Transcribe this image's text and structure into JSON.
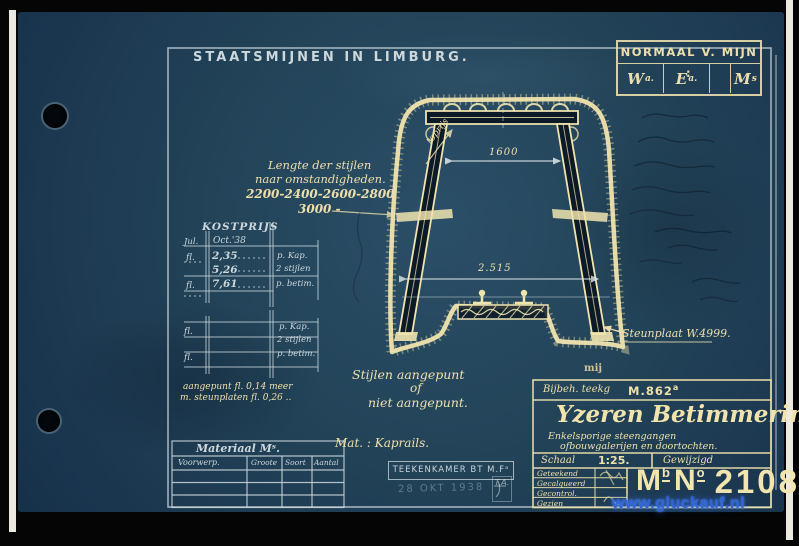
{
  "header": {
    "title": "STAATSMIJNEN  IN  LIMBURG."
  },
  "normaal": {
    "label": "NORMAAL V. MIJN :",
    "cells": [
      {
        "main": "W",
        "sup": "a."
      },
      {
        "main": "E",
        "sup": "a."
      },
      {
        "main": "",
        "sup": ""
      },
      {
        "main": "M",
        "sup": "s"
      }
    ]
  },
  "lengte": {
    "line1": "Lengte der stijlen",
    "line2": "naar omstandigheden.",
    "line3": "2200-2400-2600-2800",
    "line4": "3000 -"
  },
  "kostprijs": {
    "title": "KOSTPRIJS",
    "head_left": "Jul.",
    "head_right": "Oct.'38",
    "rows_top": [
      {
        "fl": "fl.",
        "value": "2,35",
        "unit": "p. Kap."
      },
      {
        "fl": "",
        "value": "5,26",
        "unit": "2 stijlen"
      },
      {
        "fl": "fl.",
        "value": "7,61",
        "unit": "p. betim."
      }
    ],
    "rows_bottom": [
      {
        "fl": "fl.",
        "unit": "p. Kap."
      },
      {
        "fl": "",
        "unit": "2 stijlen"
      },
      {
        "fl": "fl.",
        "unit": "p. betim."
      }
    ],
    "note_line1": "aangepunt  fl. 0,14 meer",
    "note_line2": "m. steunplaten fl. 0,26 .."
  },
  "drawing": {
    "dim_top": "1600",
    "dim_bottom": "2.515",
    "toprijs_label": "toprijs",
    "steunplaat_label": "Steunplaat  W.4999.",
    "mij_label": "mij"
  },
  "notes": {
    "stijlen_line1": "Stijlen aangepunt",
    "stijlen_line2": "of",
    "stijlen_line3": "niet aangepunt.",
    "mat_label": "Mat. : Kaprails."
  },
  "materiaal": {
    "title": "Materiaal Mˢ.",
    "columns": [
      "Voorwerp.",
      "Groote",
      "Soort",
      "Aantal"
    ]
  },
  "stamp": {
    "line1": "TEEKENKAMER BT M.Fᵃ",
    "date": "28 OKT 1938",
    "monogram": "T.A."
  },
  "titleblock": {
    "bijbeh_label": "Bijbeh. teekg",
    "bijbeh_number": "M.862",
    "bijbeh_sup": "a",
    "main_title": "Yzeren Betimmering",
    "main_title_suffix": "v.",
    "subtitle1": "Enkelsporige steengangen",
    "subtitle2": "ofbouwgalerijen en doortochten.",
    "schaal_label": "Schaal",
    "schaal_value": "1:25.",
    "gewijzigd_label": "Gewijzigd",
    "sign_rows": [
      "Geteekend",
      "Gecalqueerd",
      "Gecontrol.",
      "Gezien"
    ],
    "no_m": "M",
    "no_m_sup": "b",
    "no_n": "N",
    "no_n_sup": "o",
    "no_value": "2108"
  },
  "watermark": {
    "text": "www.gluckauf.nl"
  },
  "colors": {
    "paper": "#1f3e57",
    "ink_cream": "#eee0ab",
    "ink_white": "#ccd8db",
    "watermark_blue": "#2f65d8"
  }
}
